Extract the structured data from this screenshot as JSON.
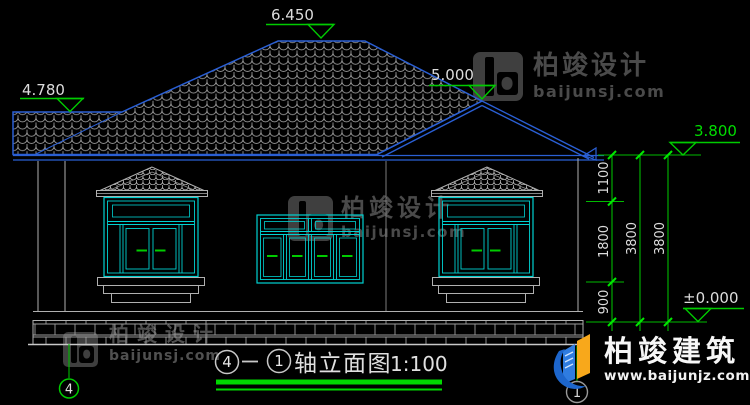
{
  "drawing_title": {
    "from": "4",
    "to": "1",
    "name": "轴立面图",
    "scale": "1:100"
  },
  "elevation_markers": [
    {
      "label": "left-roof-level",
      "value": "4.780"
    },
    {
      "label": "main-ridge-level",
      "value": "6.450"
    },
    {
      "label": "porch-gable-level",
      "value": "5.000"
    },
    {
      "label": "right-eave-level",
      "value": "3.800"
    },
    {
      "label": "ground-level",
      "value": "±0.000"
    }
  ],
  "dim_chain": {
    "segments": [
      "1100",
      "1800",
      "900"
    ],
    "totals": [
      "3800",
      "3800"
    ]
  },
  "axis": {
    "left": "4",
    "right": "1"
  },
  "watermark": {
    "monogram_icon": "b-monogram",
    "cn": "柏竣设计",
    "domain": "baijunsj.com"
  },
  "brand": {
    "cn": "柏竣建筑",
    "domain": "www.baijunjz.com"
  },
  "colors": {
    "roof_blue": "#2a5fd4",
    "window_cyan": "#00d2d2",
    "dim_green": "#00bb00",
    "tick_green": "#00e800",
    "line_gray": "#b0b0b0",
    "text_gray": "#dcdcdc",
    "watermark_gray": "#4a4a4a",
    "brand_blue": "#1d66cc",
    "brand_yellow": "#f8a81b"
  }
}
